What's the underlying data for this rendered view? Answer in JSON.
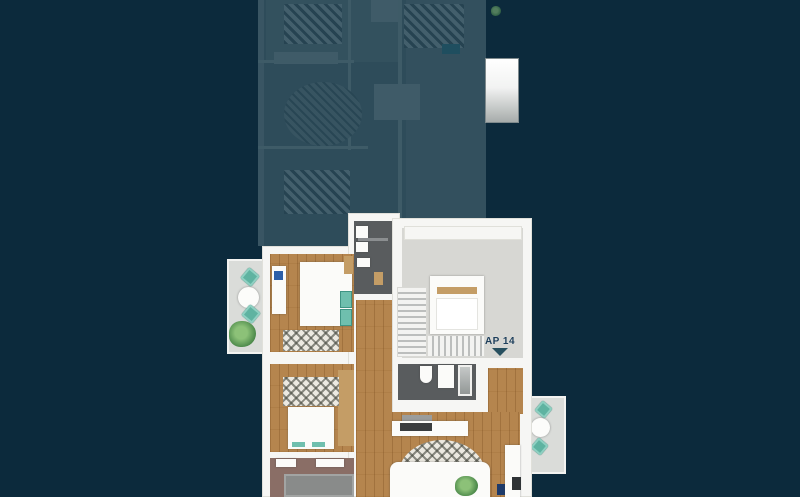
{
  "scene": {
    "active_unit": {
      "label": "AP 14",
      "marker_icon": "triangle-down-icon",
      "accent_color": "#5fb3a1",
      "label_color": "#1d3e5a"
    },
    "colors": {
      "background": "#0c2a3c",
      "inactive_overlay": "#12364c",
      "wood_floor": "#b5854e",
      "wall": "#f6f6f4"
    }
  }
}
